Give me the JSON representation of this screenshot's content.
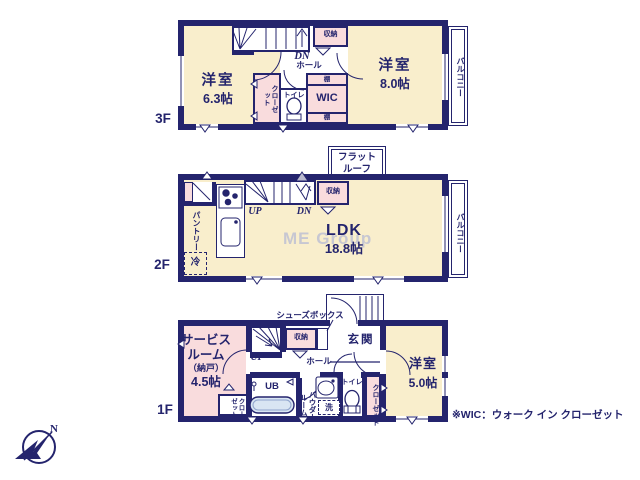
{
  "note": {
    "wic": "※WIC：ウォーク イン クローゼット"
  },
  "watermark": "ME Group",
  "compass": {
    "n": "N"
  },
  "floor3": {
    "label": "3F",
    "room_w1": {
      "name": "洋室",
      "size": "6.3帖"
    },
    "room_w2": {
      "name": "洋室",
      "size": "8.0帖"
    },
    "closet": "クローゼット",
    "toilet": "トイレ",
    "wic": "WIC",
    "shelf_top": "棚",
    "shelf_bottom": "棚",
    "storage": "収納",
    "stair_dn": "DN",
    "hall": "ホール",
    "balcony": "バルコニー"
  },
  "floor2": {
    "label": "2F",
    "ldk": {
      "name": "LDK",
      "size": "18.8帖"
    },
    "pantry": "パントリー",
    "fridge": "冷",
    "storage": "収納",
    "stair_up": "UP",
    "stair_dn": "DN",
    "flat_roof": "フラットルーフ",
    "balcony": "バルコニー"
  },
  "floor1": {
    "label": "1F",
    "service_room": {
      "line1": "サービス",
      "line2": "ルーム",
      "line3": "（納戸）",
      "size": "4.5帖"
    },
    "room_w3": {
      "name": "洋室",
      "size": "5.0帖"
    },
    "entrance": "玄関",
    "hall": "ホール",
    "shoes_box": "シューズボックス",
    "storage": "収納",
    "stair_up": "UP",
    "ub": "UB",
    "powder_room": "パウダールーム",
    "laundry": "洗",
    "toilet": "トイレ",
    "closet_right": "クローゼット",
    "closet_left": "クローゼット"
  },
  "colors": {
    "wall": "#24246D",
    "cream": "#F9EECC",
    "pink": "#F9DCDD",
    "tub": "#D9E5F3",
    "watermark": "#C7C7D2"
  }
}
